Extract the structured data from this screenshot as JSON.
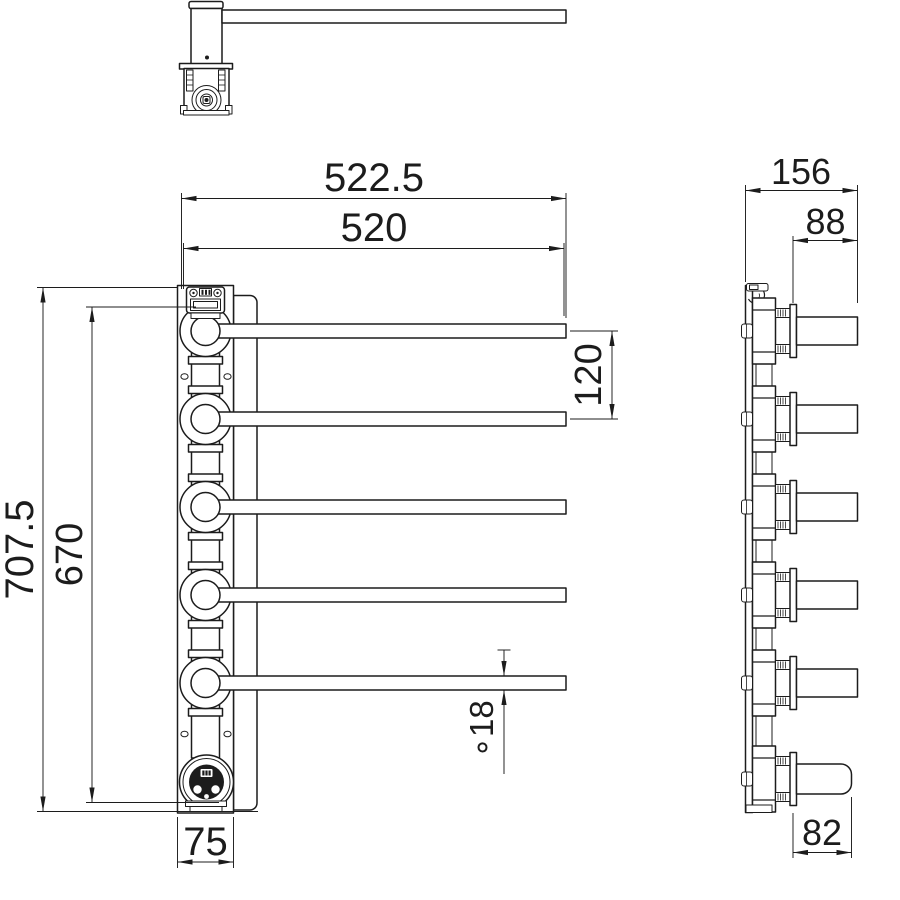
{
  "drawing": {
    "type": "technical-orthographic-drawing",
    "subject": "wall-mounted swing-arm towel rail with electric socket",
    "background_color": "#ffffff",
    "line_color": "#1c1c1c",
    "views": {
      "top_view_name": "top view",
      "front_view_name": "front view",
      "side_view_name": "side view"
    },
    "dimensions": {
      "overall_width": "522.5",
      "bar_length": "520",
      "overall_height": "707.5",
      "pivot_span": "670",
      "bar_spacing": "120",
      "bar_diameter": "∘18",
      "column_width": "75",
      "overall_depth": "156",
      "bar_projection": "88",
      "lower_projection": "82"
    }
  }
}
